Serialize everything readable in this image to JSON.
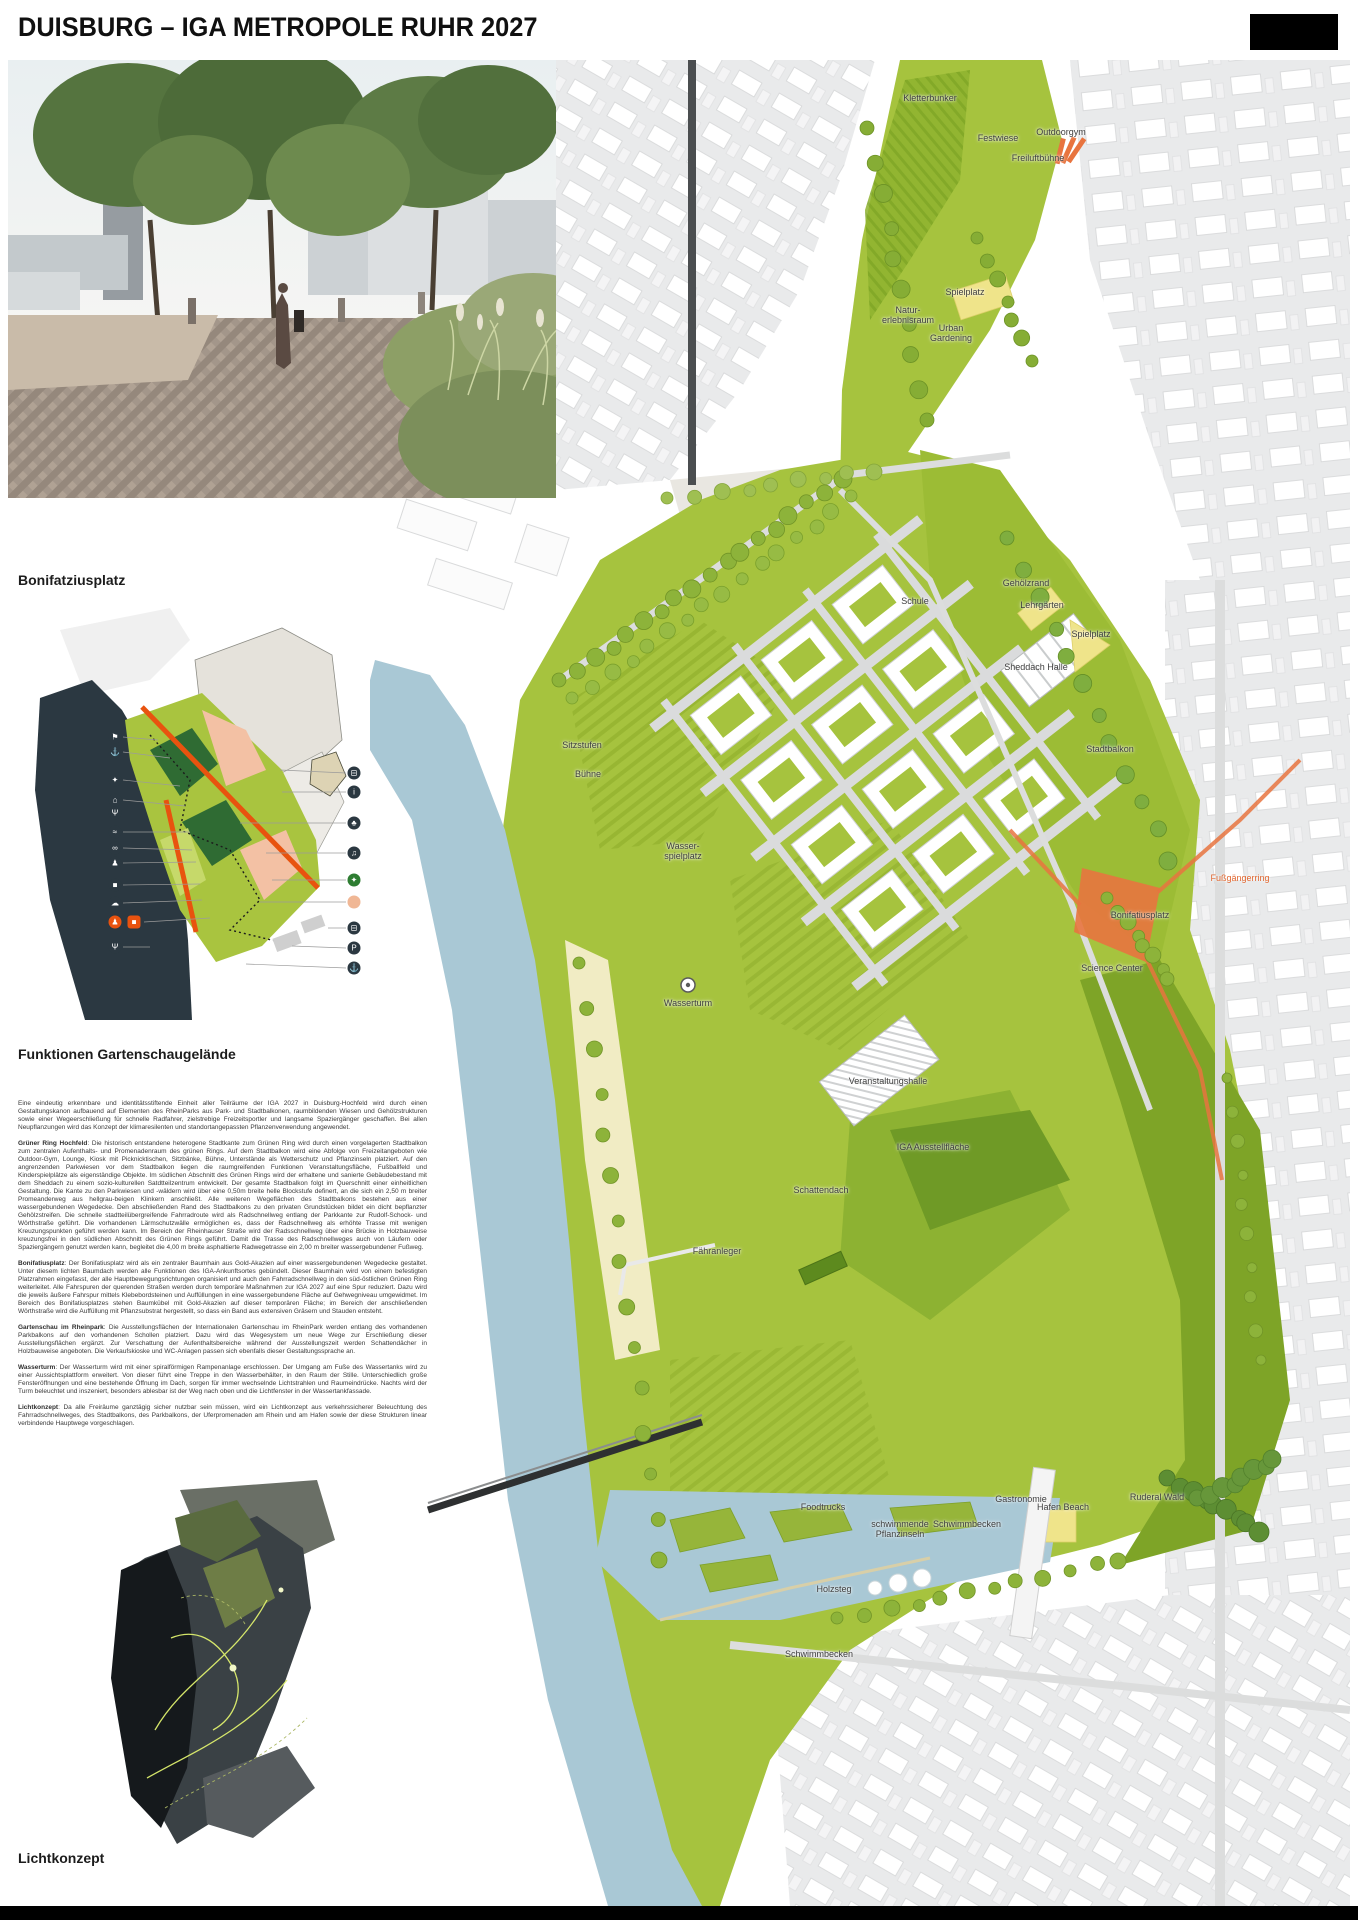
{
  "header": {
    "title": "DUISBURG – IGA METROPOLE RUHR 2027"
  },
  "captions": {
    "photo": "Bonifatziusplatz",
    "functions_diagram": "Funktionen Gartenschaugelände",
    "light_diagram": "Lichtkonzept"
  },
  "colors": {
    "accent_orange": "#e8520f",
    "park_green": "#a6c33e",
    "dark_green": "#2f6b33",
    "water_blue": "#a9c8d5",
    "navy": "#2b3841",
    "play_yellow": "#efe48a"
  },
  "article": {
    "paragraphs": [
      {
        "lead": "",
        "text": "Eine eindeutig erkennbare und identitätsstiftende Einheit aller Teilräume der IGA 2027 in Duisburg-Hochfeld wird durch einen Gestaltungskanon aufbauend auf Elementen des RheinParks aus Park- und Stadtbalkonen, raumbildenden Wiesen und Gehölzstrukturen sowie einer Wegeerschließung für schnelle Radfahrer, zielstrebige Freizeitsportler und langsame Spaziergänger geschaffen. Bei allen Neupflanzungen wird das Konzept der klimaresilenten und standortangepassten Pflanzenverwendung angewendet."
      },
      {
        "lead": "Grüner Ring Hochfeld",
        "text": ": Die historisch entstandene heterogene Stadtkante zum Grünen Ring wird durch einen vorgelagerten Stadtbalkon zum zentralen Aufenthalts- und Promenadenraum des grünen Rings. Auf dem Stadtbalkon wird eine Abfolge von Freizeitangeboten wie Outdoor-Gym, Lounge, Kiosk mit Picknicktischen, Sitzbänke, Bühne, Unterstände als Wetterschutz und Pflanzinseln platziert. Auf den angrenzenden Parkwiesen vor dem Stadtbalkon liegen die raumgreifenden Funktionen Veranstaltungsfläche, Fußballfeld und Kinderspielplätze als eigenständige Objekte. Im südlichen Abschnitt des Grünen Rings wird der erhaltene und sanierte Gebäudebestand mit dem Sheddach zu einem sozio-kulturellen Satdtteilzentrum entwickelt. Der gesamte Stadtbalkon folgt im Querschnitt einer einheitlichen Gestaltung. Die Kante zu den Parkwiesen und -wäldern wird über eine 0,50m breite helle Blockstufe definert, an die sich ein 2,50 m breiter Promeanderweg aus hellgrau-beigen Klinkern anschließt. Alle weiteren Wegeflächen des Stadtbalkons bestehen aus einer wassergebundenen Wegedecke. Den abschließenden Rand des Stadtbalkons zu den privaten Grundstücken bildet ein dicht bepflanzter Gehölzstreifen. Die schnelle stadtteilübergreifende Fahrradroute wird als Radschnellweg entlang der Parkkante zur Rudolf-Schock- und Wörthstraße geführt. Die vorhandenen Lärmschutzwälle ermöglichen es, dass der Radschnellweg als erhöhte Trasse mit wenigen Kreuzungspunkten geführt werden kann. Im Bereich der Rheinhauser Straße wird der Radsschnellweg über eine Brücke in Holzbauweise kreuzungsfrei in den südlichen Abschnitt des Grünen Rings geführt. Damit die Trasse des Radschnellweges auch von Läufern oder Spaziergängern genutzt werden kann, begleitet die 4,00 m breite asphaltierte Radwegetrasse ein 2,00 m breiter wassergebundener Fußweg."
      },
      {
        "lead": "Bonifatiusplatz",
        "text": ": Der Bonifatiusplatz wird als ein zentraler Baumhain aus Gold-Akazien auf einer wassergebundenen Wegedecke gestaltet. Unter diesem lichten Baumdach werden alle Funktionen des IGA-Ankunftsortes gebündelt. Dieser Baumhain wird von einem befestigten Platzrahmen eingefasst, der alle Hauptbewegungsrichtungen organisiert und auch den Fahrradschnellweg in den süd-östlichen Grünen Ring weiterleitet. Alle Fahrspuren der querenden Straßen werden durch temporäre Maßnahmen zur IGA 2027 auf eine Spur reduziert. Dazu wird die jeweils äußere Fahrspur mittels Klebebordsteinen und Auffüllungen in eine wassergebundene Fläche auf Gehwegniveau umgewidmet. Im Bereich des Bonifatiusplatzes stehen Baumkübel mit Gold-Akazien auf dieser temporären Fläche; im Bereich der anschließenden Wörthstraße wird die Auffüllung mit Pflanzsubstrat hergestellt, so dass ein Band aus extensiven Gräsern und Stauden entsteht."
      },
      {
        "lead": "Gartenschau im Rheinpark",
        "text": ": Die Ausstellungsflächen der Internationalen Gartenschau im RheinPark werden entlang des vorhandenen Parkbalkons auf den vorhandenen Schollen platziert. Dazu wird das Wegesystem um neue Wege zur Erschließung dieser Ausstellungsflächen ergänzt. Zur Verschattung der Aufenthaltsbereiche während der Ausstellungszeit werden Schattendächer in Holzbauweise angeboten. Die Verkaufskioske und WC-Anlagen passen sich ebenfalls dieser Gestaltungssprache an."
      },
      {
        "lead": "Wasserturm",
        "text": ": Der Wasserturm wird mit einer spiralförmigen Rampenanlage erschlossen. Der Umgang am Fuße des Wassertanks wird zu einer Aussichtsplattform erweitert. Von dieser führt eine Treppe in den Wasserbehälter, in den Raum der Stille. Unterschiedlich große Fensteröffnungen und eine bestehende Öffnung im Dach, sorgen für immer wechselnde Lichtstrahlen und Raumeindrücke. Nachts wird der Turm beleuchtet und inszeniert, besonders ablesbar ist der Weg nach oben und die Lichtfenster in der Wassertankfassade."
      },
      {
        "lead": "Lichtkonzept",
        "text": ": Da alle Freiräume ganztägig sicher nutzbar sein müssen, wird ein Lichtkonzept aus verkehrssicherer Beleuchtung des Fahrradschnellweges, des Stadtbalkons, des Parkbalkons, der Uferpromenaden am Rhein und am Hafen sowie der diese Strukturen linear verbindende Hauptwege vorgeschlagen."
      }
    ]
  },
  "map": {
    "labels": [
      {
        "t": "Kletterbunker",
        "x": 930,
        "y": 98
      },
      {
        "t": "Festwiese",
        "x": 998,
        "y": 138
      },
      {
        "t": "Outdoorgym",
        "x": 1061,
        "y": 132
      },
      {
        "t": "Freiluftbühne",
        "x": 1038,
        "y": 158
      },
      {
        "t": "Spielplatz",
        "x": 965,
        "y": 292
      },
      {
        "t": "Natur-\nerlebnisraum",
        "x": 908,
        "y": 315
      },
      {
        "t": "Urban\nGardening",
        "x": 951,
        "y": 333
      },
      {
        "t": "Gehölzrand",
        "x": 1026,
        "y": 583
      },
      {
        "t": "Schule",
        "x": 915,
        "y": 601
      },
      {
        "t": "Lehrgärten",
        "x": 1042,
        "y": 605
      },
      {
        "t": "Spielplatz",
        "x": 1091,
        "y": 634
      },
      {
        "t": "Sheddach Halle",
        "x": 1036,
        "y": 667
      },
      {
        "t": "Stadtbalkon",
        "x": 1110,
        "y": 749
      },
      {
        "t": "Sitzstufen",
        "x": 582,
        "y": 745
      },
      {
        "t": "Bühne",
        "x": 588,
        "y": 774
      },
      {
        "t": "Wasser-\nspielplatz",
        "x": 683,
        "y": 851
      },
      {
        "t": "Fußgängerring",
        "x": 1240,
        "y": 878,
        "c": "orange"
      },
      {
        "t": "Bonifatiusplatz",
        "x": 1140,
        "y": 915
      },
      {
        "t": "Science Center",
        "x": 1112,
        "y": 968
      },
      {
        "t": "Wasserturm",
        "x": 688,
        "y": 1003
      },
      {
        "t": "Veranstaltungshalle",
        "x": 888,
        "y": 1081
      },
      {
        "t": "IGA Ausstellfläche",
        "x": 933,
        "y": 1147
      },
      {
        "t": "Schattendach",
        "x": 821,
        "y": 1190
      },
      {
        "t": "Fähranleger",
        "x": 717,
        "y": 1251
      },
      {
        "t": "Foodtrucks",
        "x": 823,
        "y": 1507
      },
      {
        "t": "Gastronomie",
        "x": 1021,
        "y": 1499
      },
      {
        "t": "Hafen Beach",
        "x": 1063,
        "y": 1507
      },
      {
        "t": "Ruderal Wald",
        "x": 1157,
        "y": 1497
      },
      {
        "t": "schwimmende\nPflanzinseln",
        "x": 900,
        "y": 1529
      },
      {
        "t": "Schwimmbecken",
        "x": 967,
        "y": 1524
      },
      {
        "t": "Holzsteg",
        "x": 834,
        "y": 1589
      },
      {
        "t": "Schwimmbecken",
        "x": 819,
        "y": 1654
      }
    ]
  },
  "legend": {
    "icons": [
      {
        "n": "gym-icon",
        "x": 85,
        "y": 137,
        "g": "⚑",
        "bg": "navy"
      },
      {
        "n": "slipway-icon",
        "x": 85,
        "y": 152,
        "g": "⚓",
        "bg": "navy"
      },
      {
        "n": "playground-icon",
        "x": 85,
        "y": 180,
        "g": "✦",
        "bg": "navy"
      },
      {
        "n": "kiosk-icon",
        "x": 85,
        "y": 200,
        "g": "⌂",
        "bg": "navy"
      },
      {
        "n": "gastronomy-icon",
        "x": 85,
        "y": 213,
        "g": "Ψ",
        "bg": "navy"
      },
      {
        "n": "water-feature-icon",
        "x": 85,
        "y": 232,
        "g": "≈",
        "bg": "navy"
      },
      {
        "n": "bike-icon",
        "x": 85,
        "y": 248,
        "g": "∞",
        "bg": "navy"
      },
      {
        "n": "pedestrian-icon",
        "x": 85,
        "y": 263,
        "g": "♟",
        "bg": "navy"
      },
      {
        "n": "car-icon",
        "x": 85,
        "y": 285,
        "g": "■",
        "bg": "navy"
      },
      {
        "n": "lounge-icon",
        "x": 85,
        "y": 303,
        "g": "☁",
        "bg": "navy"
      },
      {
        "n": "pedestrian-orange-icon",
        "x": 85,
        "y": 322,
        "g": "♟",
        "bg": "orange"
      },
      {
        "n": "shuttle-orange-icon",
        "x": 104,
        "y": 322,
        "g": "■",
        "bg": "orange",
        "sq": true
      },
      {
        "n": "picnic-icon",
        "x": 85,
        "y": 347,
        "g": "Ψ",
        "bg": "navy"
      },
      {
        "n": "bus-stop-icon",
        "x": 324,
        "y": 173,
        "g": "⊟",
        "bg": "navy"
      },
      {
        "n": "info-icon",
        "x": 324,
        "y": 192,
        "g": "i",
        "bg": "navy"
      },
      {
        "n": "tree-icon",
        "x": 324,
        "y": 223,
        "g": "♣",
        "bg": "navy"
      },
      {
        "n": "stage-icon",
        "x": 324,
        "y": 253,
        "g": "♫",
        "bg": "navy"
      },
      {
        "n": "entrance-green-icon",
        "x": 324,
        "y": 280,
        "g": "✦",
        "bg": "green"
      },
      {
        "n": "temporary-area-icon",
        "x": 324,
        "y": 302,
        "g": "",
        "bg": "peach"
      },
      {
        "n": "bus-icon",
        "x": 324,
        "y": 328,
        "g": "⊟",
        "bg": "navy"
      },
      {
        "n": "parking-icon",
        "x": 324,
        "y": 348,
        "g": "P",
        "bg": "navy"
      },
      {
        "n": "ferry-icon",
        "x": 324,
        "y": 368,
        "g": "⚓",
        "bg": "navy"
      }
    ],
    "bg": {
      "navy": "#2b3841",
      "orange": "#e8520f",
      "green": "#2e7d32",
      "peach": "#f0b795"
    }
  }
}
